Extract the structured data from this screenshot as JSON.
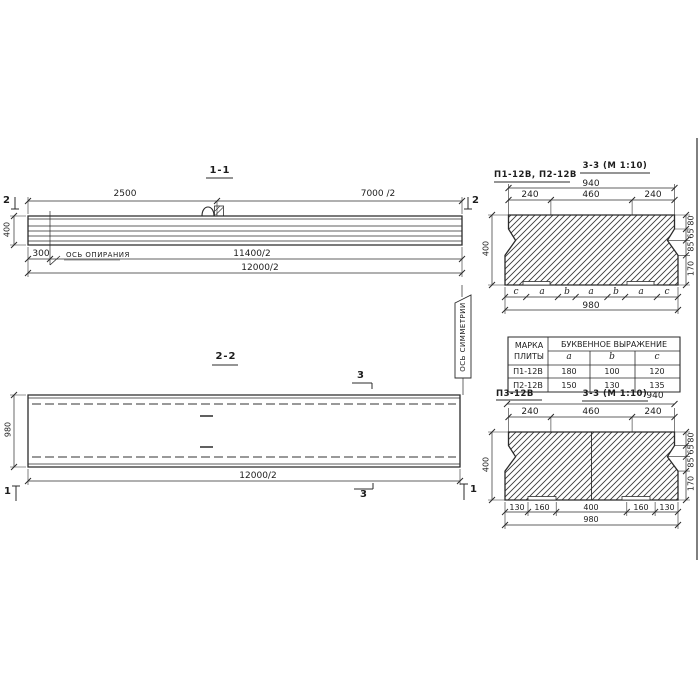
{
  "sec11": {
    "title": "1-1",
    "dim_2500": "2500",
    "dim_7000": "7000 /2",
    "marker_left": "2",
    "marker_right": "2",
    "dim_400": "400",
    "dim_300": "300",
    "support_axis": "ОСЬ ОПИРАНИЯ",
    "dim_11400": "11400/2",
    "dim_12000": "12000/2"
  },
  "sec22": {
    "title": "2-2",
    "dim_980": "980",
    "dim_12000": "12000/2",
    "marker3": "3",
    "marker1": "1",
    "symmetry_axis": "ОСЬ СИММЕТРИИ"
  },
  "xsec_top": {
    "title": "3-3 (М 1:10)",
    "label": "П1-12В, П2-12В",
    "dim_940": "940",
    "dims_top": [
      "240",
      "460",
      "240"
    ],
    "dim_400": "400",
    "dims_right": [
      "80",
      "65",
      "85",
      "170"
    ],
    "letters": [
      "c",
      "a",
      "b",
      "a",
      "b",
      "a",
      "c"
    ],
    "dim_980": "980"
  },
  "table": {
    "col_mark": "МАРКА ПЛИТЫ",
    "col_group": "БУКВЕННОЕ ВЫРАЖЕНИЕ",
    "cols": [
      "a",
      "b",
      "c"
    ],
    "rows": [
      {
        "mark": "П1-12В",
        "a": "180",
        "b": "100",
        "c": "120"
      },
      {
        "mark": "П2-12В",
        "a": "150",
        "b": "130",
        "c": "135"
      }
    ]
  },
  "xsec_bot": {
    "label": "П3-12В",
    "title": "3-3 (М 1:10)",
    "dim_940": "940",
    "dims_top": [
      "240",
      "460",
      "240"
    ],
    "dim_400": "400",
    "dims_right": [
      "80",
      "65",
      "85",
      "170"
    ],
    "dims_bottom": [
      "130",
      "160",
      "400",
      "160",
      "130"
    ],
    "dim_980": "980"
  }
}
